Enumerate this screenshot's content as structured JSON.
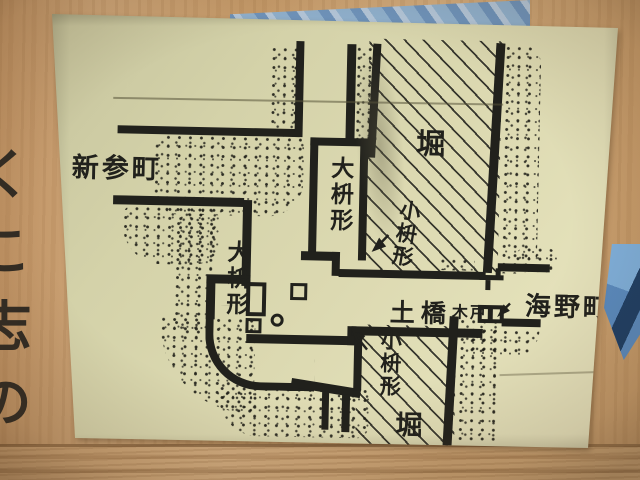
{
  "colors": {
    "paper": "#d9d6ae",
    "ink": "#21211c",
    "wood": "#c79d6c",
    "wood_plank": "#c9a172",
    "blue_object": "#6e93bb"
  },
  "wood": {
    "partial_vertical_text": "くこ志の"
  },
  "map": {
    "labels": {
      "town_left": "新参町",
      "moat_top": "堀",
      "moat_bottom": "堀",
      "masugata_large_top": "大枡形",
      "masugata_large_left": "大枡形",
      "masugata_small_top": "小枡形",
      "masugata_small_bottom": "小枡形",
      "earthen_bridge": "土橋",
      "wooden_gate": "木戸",
      "town_right": "海野町"
    }
  }
}
